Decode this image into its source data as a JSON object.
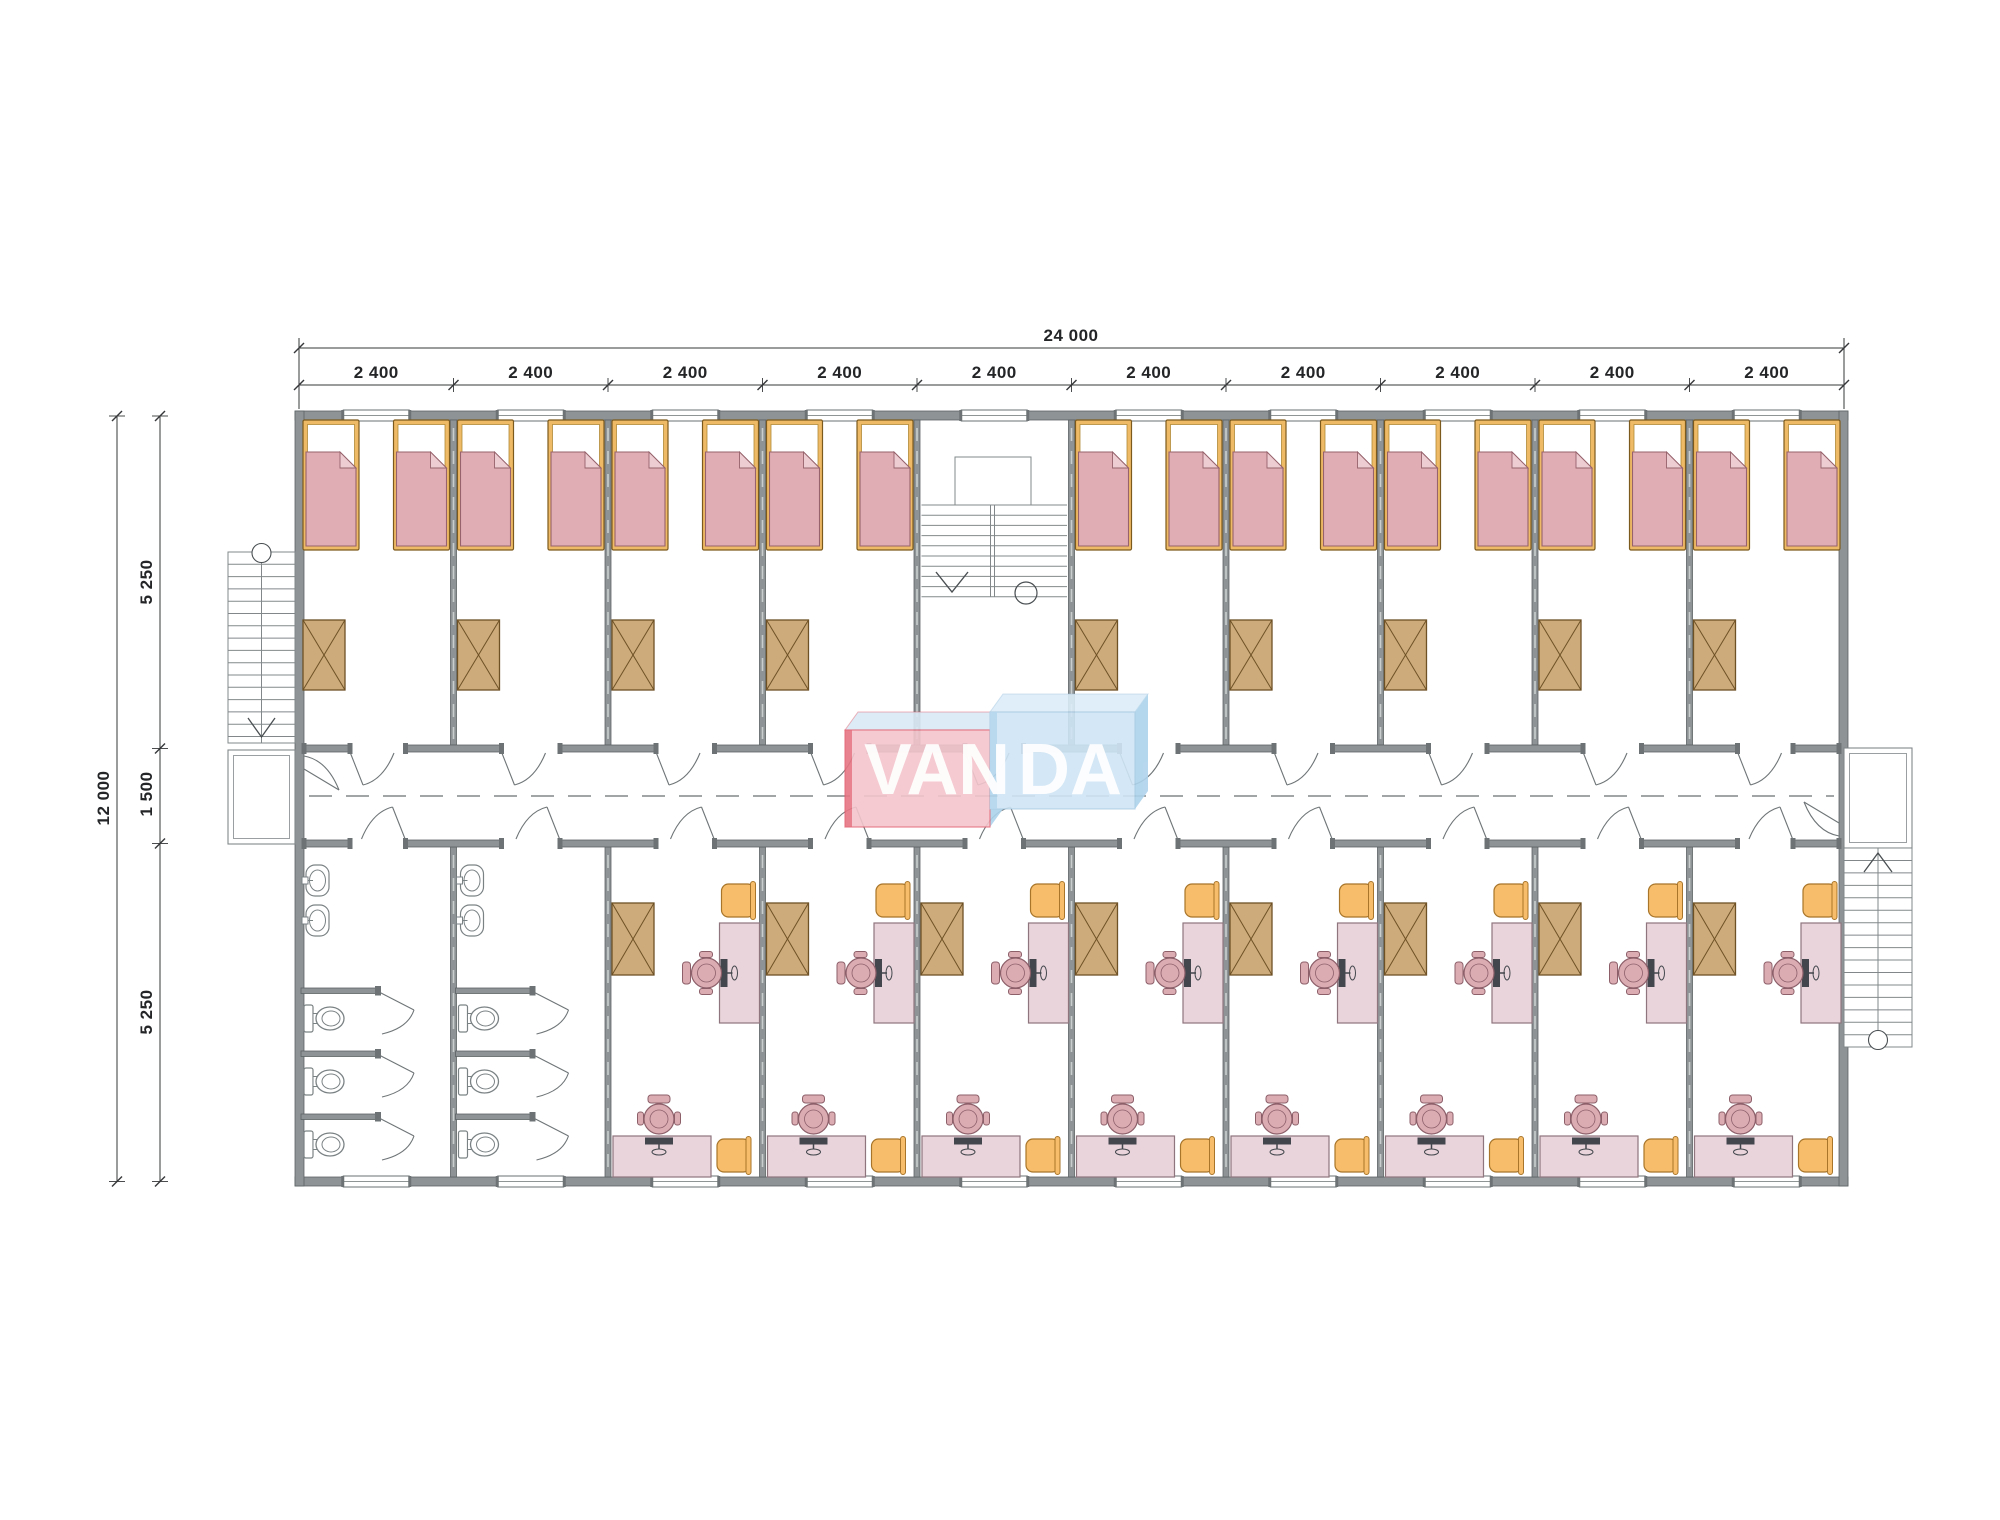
{
  "meta": {
    "drawing_type": "floor-plan",
    "background": "#ffffff"
  },
  "dimensions": {
    "top": {
      "total": "24 000",
      "bay_label": "2 400",
      "bay_count": 10
    },
    "left": {
      "total": "12 000",
      "segments": [
        "5 250",
        "1 500",
        "5 250"
      ]
    }
  },
  "logo": {
    "text": "VANDA",
    "left_part": "VAN",
    "right_part": "DA",
    "pink_front": "#f4c5cd",
    "pink_top": "#d9e9f5",
    "pink_edge": "#e15a6a",
    "blue_front": "#cfe5f6",
    "blue_top": "#dcedf9",
    "blue_side": "#aed3ec",
    "blue_edge": "#9fc4de"
  },
  "plan": {
    "bays": 10,
    "stair_bay_index": 4,
    "top_rooms": {
      "bedrooms": 9,
      "beds_per_room": 2,
      "wardrobes_per_room": 1
    },
    "bottom_rooms": {
      "bathrooms": 2,
      "sinks_per_bathroom": 2,
      "toilets_per_bathroom": 3,
      "study_rooms": 8
    },
    "totals": {
      "beds": 18,
      "wardrobes": 17,
      "desks": 16,
      "office_chairs": 16,
      "side_chairs": 16,
      "toilets": 6,
      "sinks": 4,
      "staircases_internal": 1,
      "staircases_external": 2
    }
  },
  "colors": {
    "wall_fill": "#8e9496",
    "wall_stroke": "#5d6365",
    "wall_dash": "#c9cdce",
    "jamb": "#6d7375",
    "bed_frame": "#efba65",
    "bed_frame_stroke": "#7c5a1d",
    "bed_inner_stroke": "#b08a38",
    "mattress": "#e0adb4",
    "mattress_stroke": "#97626c",
    "mattress_fold": "#eecdd2",
    "table_fill": "#cdab7b",
    "table_stroke": "#6e5226",
    "desk_fill": "#e8d4da",
    "desk_stroke": "#8f767e",
    "chair_pink": "#dcacb3",
    "chair_pink_stroke": "#8c5f69",
    "chair_orange": "#f7bd6a",
    "chair_orange_stroke": "#a8752a",
    "monitor": "#43474d",
    "fixture_stroke": "#7b8284",
    "thin_line": "#82888a",
    "arrow": "#4a4f52",
    "dim_line": "#36383a",
    "door_line": "#6f7577",
    "centerline": "#6b6f71"
  }
}
